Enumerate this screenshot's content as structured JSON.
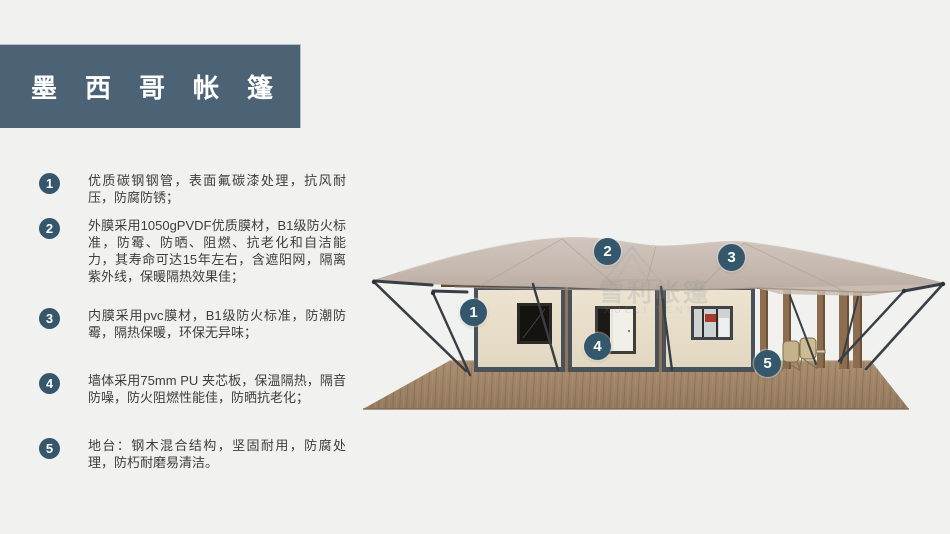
{
  "title": {
    "text": "墨西哥帐篷"
  },
  "features": [
    {
      "number": "1",
      "text": "优质碳钢钢管，表面氟碳漆处理，抗风耐压，防腐防锈；"
    },
    {
      "number": "2",
      "text": "外膜采用1050gPVDF优质膜材，B1级防火标准，防霉、防晒、阻燃、抗老化和自洁能力，其寿命可达15年左右，含遮阳网，隔离紫外线，保暖隔热效果佳；"
    },
    {
      "number": "3",
      "text": "内膜采用pvc膜材，B1级防火标准，防潮防霉，隔热保暖，环保无异味；"
    },
    {
      "number": "4",
      "text": "墙体采用75mm PU 夹芯板，保温隔热，隔音防噪，防火阻燃性能佳，防晒抗老化；"
    },
    {
      "number": "5",
      "text": "地台：钢木混合结构，坚固耐用，防腐处理，防朽耐磨易清洁。"
    }
  ],
  "tent": {
    "markers": [
      {
        "label": "1"
      },
      {
        "label": "2"
      },
      {
        "label": "3"
      },
      {
        "label": "4"
      },
      {
        "label": "5"
      }
    ],
    "watermark": {
      "cn": "雪利帐篷",
      "en": "XUELI TENT"
    }
  },
  "colors": {
    "banner": "#4b6374",
    "badge": "#36576b",
    "marker": "#35576b",
    "text": "#3d3d3d",
    "background": "#f1f1f0",
    "canopy": "#c7bab0",
    "wall": "#e9e0cc",
    "frame": "#49525a",
    "deck": "#a1876b"
  }
}
